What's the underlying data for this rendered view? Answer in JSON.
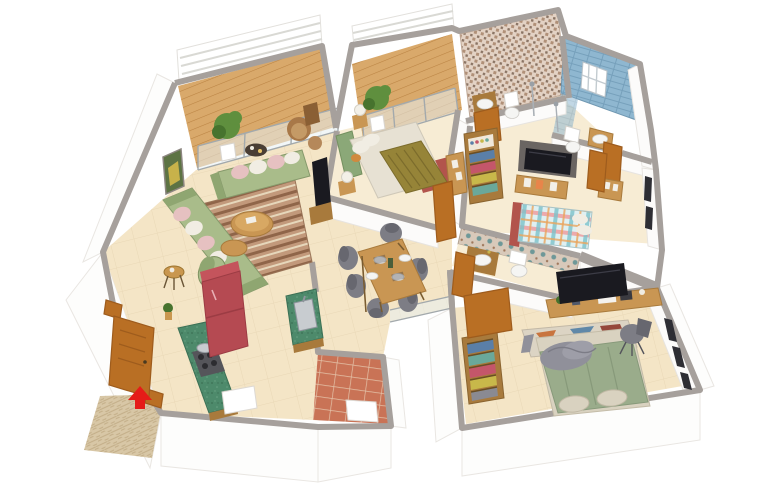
{
  "scene": {
    "type": "3d-isometric-apartment-floor-plan-render",
    "background": "#ffffff",
    "entry_marker": "red-arrow-at-main-door"
  },
  "palette": {
    "wallcap": "#a6a09c",
    "floor": "#f4e5c6",
    "floor2": "#f7ecd4",
    "deck": "#d9a96b",
    "deckline": "#ba8343",
    "terracotta": "#c97356",
    "terraline": "#e4c2a8",
    "mat": "#d8c7a6",
    "matline": "#c3ae88",
    "sofa": "#a9bc8a",
    "sofadark": "#8fa671",
    "pillowpink": "#e6c1c1",
    "pillowwhite": "#f1ede3",
    "woodmid": "#c99653",
    "wooddark": "#a87a3c",
    "rugbase": "#c2997b",
    "rugdark": "#8f6549",
    "rugcreamline": "#e6d7bb",
    "fridge": "#b54a52",
    "fridgetop": "#c4545c",
    "counter": "#4d8a6b",
    "counterdark": "#3c7055",
    "stove": "#55555a",
    "oliveblanket": "#968438",
    "sheets": "#e7e1d3",
    "headboard": "#8ba878",
    "redrug": "#b2544c",
    "mosaicbase": "#e3d2c4",
    "mosaicbrown": "#b09078",
    "mosaicdark": "#8a7464",
    "mosaic3base": "#d8c9ba",
    "mosaicteal": "#6e9898",
    "mosaiccorner": "#a0785c",
    "bluetile": "#8fb7d0",
    "bluetileline": "#76a0bb",
    "plaidbase": "#dff0f2",
    "plaidpink": "#ef9ea0",
    "plaidteal": "#7cc2ca",
    "plaidorange": "#eaa55e",
    "doorwood": "#b96f24",
    "doorframe": "#9e5c1d",
    "tvdark": "#1a1a20",
    "graychair": "#7d7d85",
    "duvet": "#9aac8b",
    "grayblanket": "#90909a",
    "cushion": "#d9d2c0",
    "rugorange": "#c8743e",
    "rugblue": "#6088a8",
    "rugcream": "#dcd4c4",
    "rugred": "#95483c",
    "plant": "#5f8f3e",
    "plantdark": "#47732e",
    "arrow": "#e51c18",
    "glass": "#e8f0f2",
    "basin": "#f5f5f3",
    "steel": "#c8ccd0",
    "clothesblue": "#5a7fa8",
    "clothesred": "#c4566a",
    "clothesyellow": "#c8b84a",
    "clothesteal": "#6aa89a",
    "clothesgray": "#8a8a92"
  },
  "rooms": [
    {
      "id": "balcony-1",
      "name": "Balcony (living room)",
      "floor": "wood-deck",
      "furniture": [
        "potted-plant",
        "rattan-lounge-chair",
        "rattan-ottoman",
        "round-tea-table",
        "louvered-railing",
        "sliding-glass-doors"
      ]
    },
    {
      "id": "living-room",
      "name": "Living room",
      "floor": "beige-tile",
      "furniture": [
        "l-shaped-green-sofa",
        "pink-and-white-cushions",
        "nesting-round-coffee-tables",
        "striped-area-rug",
        "green-accent-chair",
        "round-side-table",
        "wall-art",
        "wall-tv",
        "tv-cabinet"
      ]
    },
    {
      "id": "dining-area",
      "name": "Dining area",
      "floor": "beige-tile",
      "furniture": [
        "wooden-dining-table",
        "six-gray-chairs",
        "table-settings",
        "vase"
      ]
    },
    {
      "id": "kitchen",
      "name": "Kitchen",
      "floor": "beige-tile",
      "furniture": [
        "green-marble-counter",
        "gas-hob-with-pan",
        "sink-counter",
        "red-refrigerator",
        "white-stool"
      ]
    },
    {
      "id": "utility-balcony",
      "name": "Utility balcony",
      "floor": "terracotta-tile",
      "furniture": [
        "washer-unit"
      ]
    },
    {
      "id": "entrance-foyer",
      "name": "Entrance foyer",
      "floor": "beige-tile",
      "furniture": [
        "wooden-entry-door",
        "red-entry-arrow",
        "patterned-doormat"
      ]
    },
    {
      "id": "bedroom-2",
      "name": "Bedroom 2",
      "floor": "beige-tile",
      "furniture": [
        "double-bed-olive-throw",
        "green-curved-headboard",
        "bedside-lamps",
        "maroon-rug",
        "dresser",
        "wooden-door"
      ]
    },
    {
      "id": "balcony-2",
      "name": "Balcony (bedroom 2)",
      "floor": "wood-deck",
      "furniture": [
        "potted-plant",
        "sliding-glass-doors",
        "louvered-railing"
      ]
    },
    {
      "id": "bathroom-1",
      "name": "Bathroom 1",
      "floor": "beige-tile",
      "furniture": [
        "mosaic-tiled-wall",
        "wooden-vanity-basin",
        "toilet",
        "shower",
        "wooden-door"
      ]
    },
    {
      "id": "bathroom-2",
      "name": "Bathroom 2",
      "floor": "beige-tile",
      "furniture": [
        "blue-tiled-wall",
        "window",
        "shower-area",
        "toilet",
        "basin-cabinet",
        "wooden-door"
      ]
    },
    {
      "id": "corridor-wardrobe",
      "name": "Corridor wardrobe",
      "floor": "beige-tile",
      "furniture": [
        "open-wardrobe-folded-clothes",
        "cosmetics-shelf"
      ]
    },
    {
      "id": "bedroom-3",
      "name": "Bedroom 3",
      "floor": "beige-tile",
      "furniture": [
        "plaid-double-bed",
        "maroon-rug-strip",
        "wall-tv-panel",
        "media-unit-with-frames",
        "side-dresser",
        "wooden-door",
        "windows"
      ]
    },
    {
      "id": "bathroom-3",
      "name": "Bathroom 3",
      "floor": "light-tile",
      "furniture": [
        "mosaic-feature-wall",
        "wooden-vanity-basin",
        "toilet",
        "wooden-door"
      ]
    },
    {
      "id": "master-bedroom",
      "name": "Master bedroom",
      "floor": "beige-tile",
      "furniture": [
        "double-bed-green-duvet",
        "gray-throw-blanket",
        "foot-cushions",
        "geometric-rug",
        "long-study-desk",
        "desk-tv",
        "desk-chair",
        "open-wardrobe-folded-clothes",
        "wooden-door",
        "windows"
      ]
    }
  ]
}
